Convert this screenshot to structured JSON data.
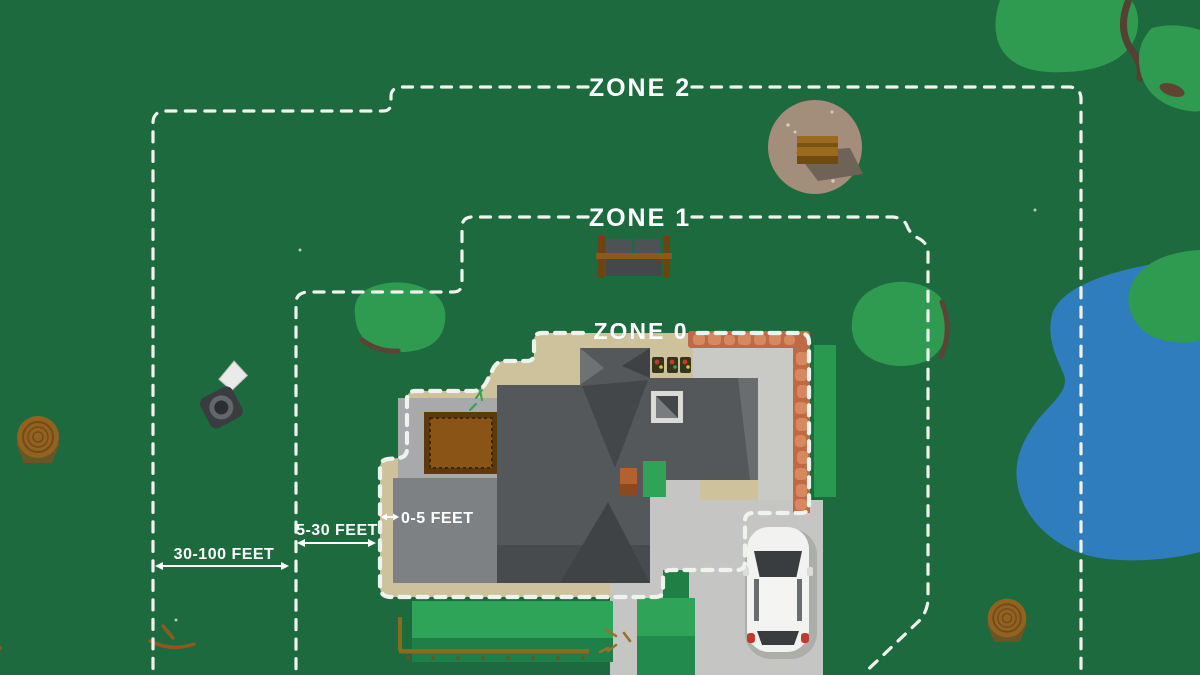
{
  "diagram": {
    "title": "Defensible space zones around a home",
    "zone_labels": [
      {
        "id": "zone-2",
        "label": "ZONE 2"
      },
      {
        "id": "zone-1",
        "label": "ZONE 1"
      },
      {
        "id": "zone-0",
        "label": "ZONE 0"
      }
    ],
    "distance_labels": [
      {
        "id": "d-0-5",
        "label": "0-5 FEET"
      },
      {
        "id": "d-5-30",
        "label": "5-30 FEET"
      },
      {
        "id": "d-30-100",
        "label": "30-100 FEET"
      }
    ],
    "objects": [
      "house-roof",
      "garage",
      "wood-deck",
      "concrete-pad",
      "brick-patio",
      "hedge",
      "driveway",
      "walkway",
      "car",
      "lawn",
      "garden-row",
      "bench",
      "fire-pit",
      "pond",
      "tree-canopy",
      "tree-stump",
      "sprinkler",
      "twigs",
      "flower-pots",
      "chimney"
    ],
    "colors": {
      "background": "#1e6a3f",
      "tree": "#2f9b51",
      "lawn": "#2ea458",
      "pond": "#2f7dbd",
      "zone_line": "#eef3ee",
      "tan_buffer": "#cdc29b",
      "brick": "#c06a45",
      "brick_stone": "#d6885f",
      "patio": "#c9cac6",
      "driveway": "#c5c6c3",
      "roof": "#55585a",
      "roof_dark": "#3f4346",
      "garage": "#7e8183",
      "concrete": "#a7a9aa",
      "deck": "#8a5416",
      "car_body": "#f2f3f1"
    }
  }
}
